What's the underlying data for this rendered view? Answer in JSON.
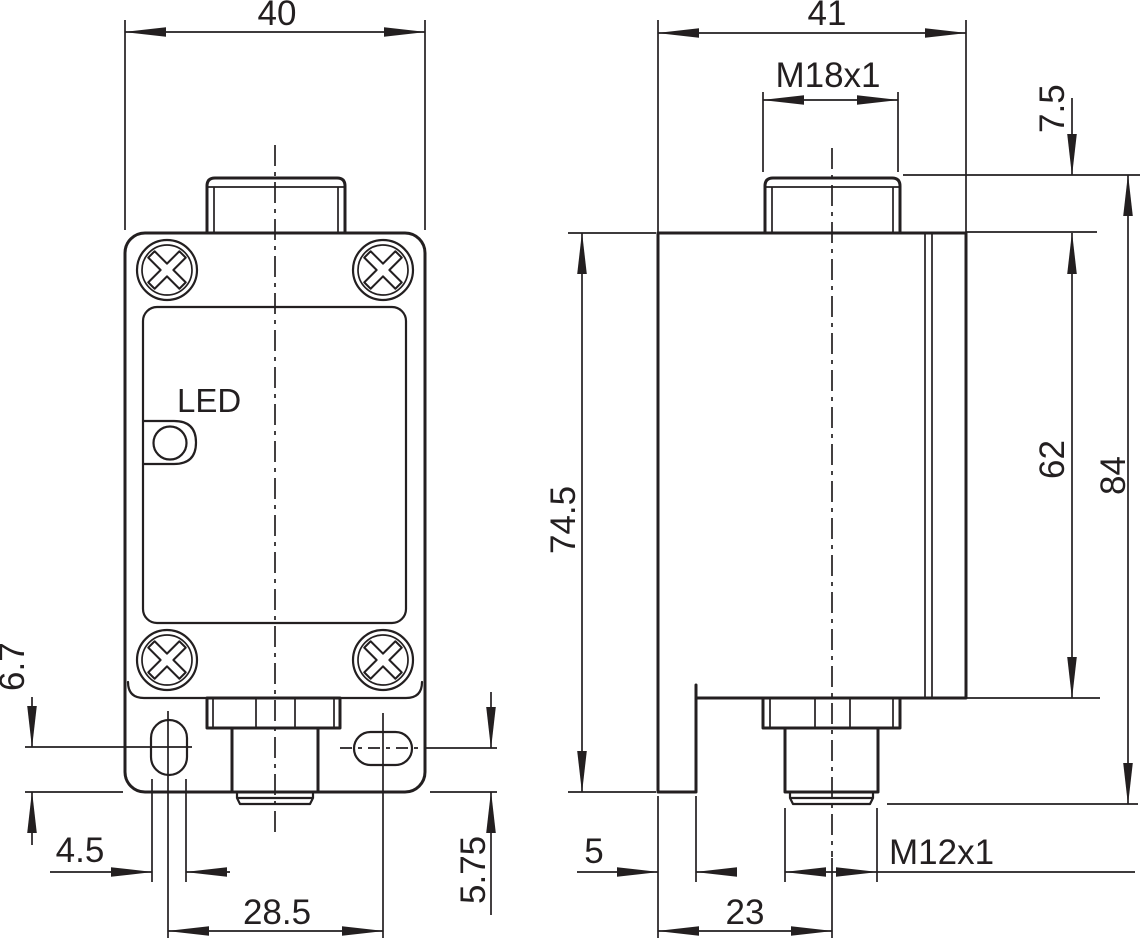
{
  "drawing_type": "technical dimension drawing, proximity sensor with mounting bracket",
  "front_view": {
    "led_label": "LED",
    "dims": {
      "overall_width": "40",
      "slot_center_to_bottom": "6.7",
      "slot_width": "4.5",
      "slot_spacing": "28.5",
      "right_slot_center_to_bottom": "5.75"
    }
  },
  "side_view": {
    "dims": {
      "overall_depth": "41",
      "sensing_face_thread": "M18x1",
      "thread_protrusion": "7.5",
      "bracket_height": "74.5",
      "housing_height": "62",
      "overall_height": "84",
      "bracket_thickness": "5",
      "connector_axis_offset": "23",
      "connector_thread": "M12x1"
    }
  },
  "colors": {
    "line": "#231f20",
    "background": "#ffffff"
  }
}
